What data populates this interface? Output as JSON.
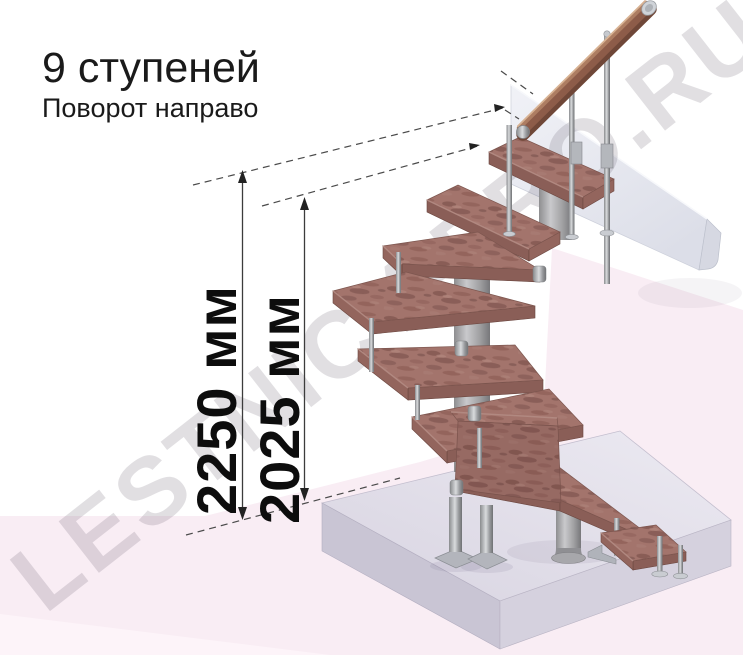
{
  "header": {
    "title": "9 ступеней",
    "subtitle": "Поворот направо"
  },
  "dimensions": {
    "overall_height": "2250 мм",
    "height_to_landing": "2025 мм"
  },
  "watermark": {
    "text": "LESTNICY-PRO.RU"
  },
  "figure": {
    "steps_count": "9",
    "turn_direction": "направо"
  },
  "colors": {
    "tread_wood": "#a3746c",
    "handrail_wood": "#8d5c49",
    "metal_highlight": "#d9dbdd",
    "floor_slab": "#dcd8e4",
    "landing_slab": "#edeef4",
    "background_pink": "#f9edf4",
    "background_pink_light": "#fdf4f9",
    "dimension_line": "#3c3c3c",
    "text": "#1a1a1a"
  }
}
